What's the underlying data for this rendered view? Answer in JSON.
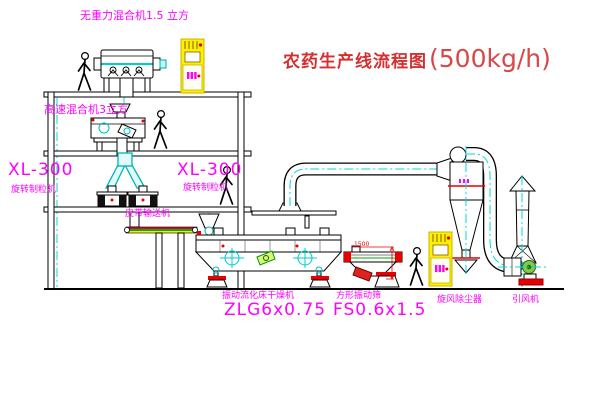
{
  "title": {
    "main": "农药生产线流程图",
    "capacity": "(500kg/h)"
  },
  "labels": {
    "gravity_mixer": "无重力混合机1.5 立方",
    "high_speed_mixer": "高速混合机3立方",
    "granulator_left_model": "XL-300",
    "granulator_left_name": "旋转制粒机",
    "granulator_right_model": "XL-300",
    "granulator_right_name": "旋转制粒机",
    "belt_conveyor": "皮带输送机",
    "dryer_name": "振动流化床干燥机",
    "dryer_model": "ZLG6x0.75",
    "screen_name": "方形振动筛",
    "screen_model": "FS0.6x1.5",
    "cyclone": "旋风除尘器",
    "fan": "引风机"
  },
  "dimensions": {
    "screen_length": "1500"
  },
  "colors": {
    "label_magenta": "#ff00ff",
    "title_red": "#d43030",
    "centerline_cyan": "#00d8d8",
    "cabinet_yellow": "#ffef00",
    "accent_red": "#e80000",
    "machine_green": "#7ecb4f"
  }
}
